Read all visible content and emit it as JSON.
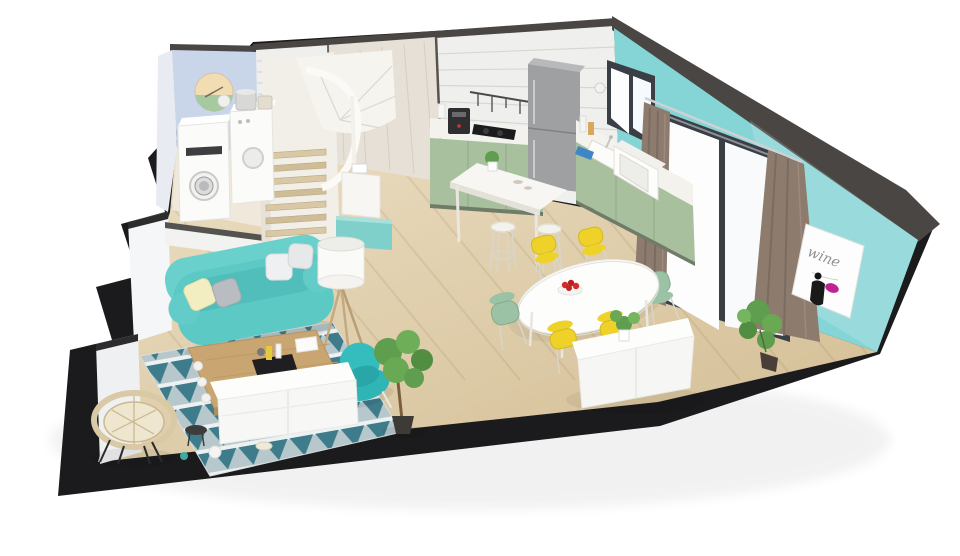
{
  "scene": {
    "name": "isometric-cutaway-apartment-render",
    "background": "#ffffff",
    "view": "3d floor plan, top-down isometric cutaway"
  },
  "palette": {
    "slab": "#1b1b1d",
    "floor_light": "#e9dcc0",
    "floor_dark": "#d2bc92",
    "laundry_floor": "#efe9dc",
    "wall_trim": "#4a4643",
    "wall_blue": "#c9d5e9",
    "wall_white": "#eff0ee",
    "wall_accent": "#e7e0d6",
    "wall_teal": "#86d5d6",
    "curtain": "#8d7b6e",
    "door_frame": "#3a3f46",
    "glass": "#fdfdfe",
    "cabinet_green": "#a9c09e",
    "counter_white": "#f4f2ec",
    "fridge_gray": "#9fa0a2",
    "sofa_teal": "#5cc9c5",
    "armchair_teal": "#2fb5b6",
    "chair_yellow": "#efd229",
    "chair_green": "#9cc2a6",
    "wood": "#c9a671",
    "stair_wood": "#d8c8a5",
    "rug_teal": "#2a6e80",
    "rug_gray": "#a5bbc1",
    "plant_green": "#5f9e4e",
    "poster_magenta": "#bf2390",
    "clock_cream": "#f2dcb2",
    "clock_green": "#a6c9a0",
    "appliance_white": "#fbfbfa"
  },
  "poster": {
    "text": "wine"
  },
  "zones": [
    {
      "id": "laundry-corner"
    },
    {
      "id": "spiral-staircase"
    },
    {
      "id": "kitchen"
    },
    {
      "id": "dining-area"
    },
    {
      "id": "living-room"
    }
  ],
  "furniture": [
    "washing-machine",
    "dryer",
    "wall-clock",
    "spiral-staircase",
    "teal-cabinet",
    "floor-lamp",
    "fridge",
    "kitchen-counter-left",
    "kitchen-counter-right",
    "cooktop",
    "coffee-machine",
    "utensil-rail",
    "sink",
    "microwave",
    "window",
    "bar-table",
    "bar-stools",
    "dining-table",
    "fruit-bowl",
    "yellow-chairs",
    "green-chairs",
    "sideboard",
    "sofa",
    "pillows",
    "coffee-table",
    "rug",
    "armchair",
    "rattan-chair",
    "tv-console",
    "potted-plants",
    "sliding-glass-door",
    "curtains",
    "wine-poster"
  ]
}
